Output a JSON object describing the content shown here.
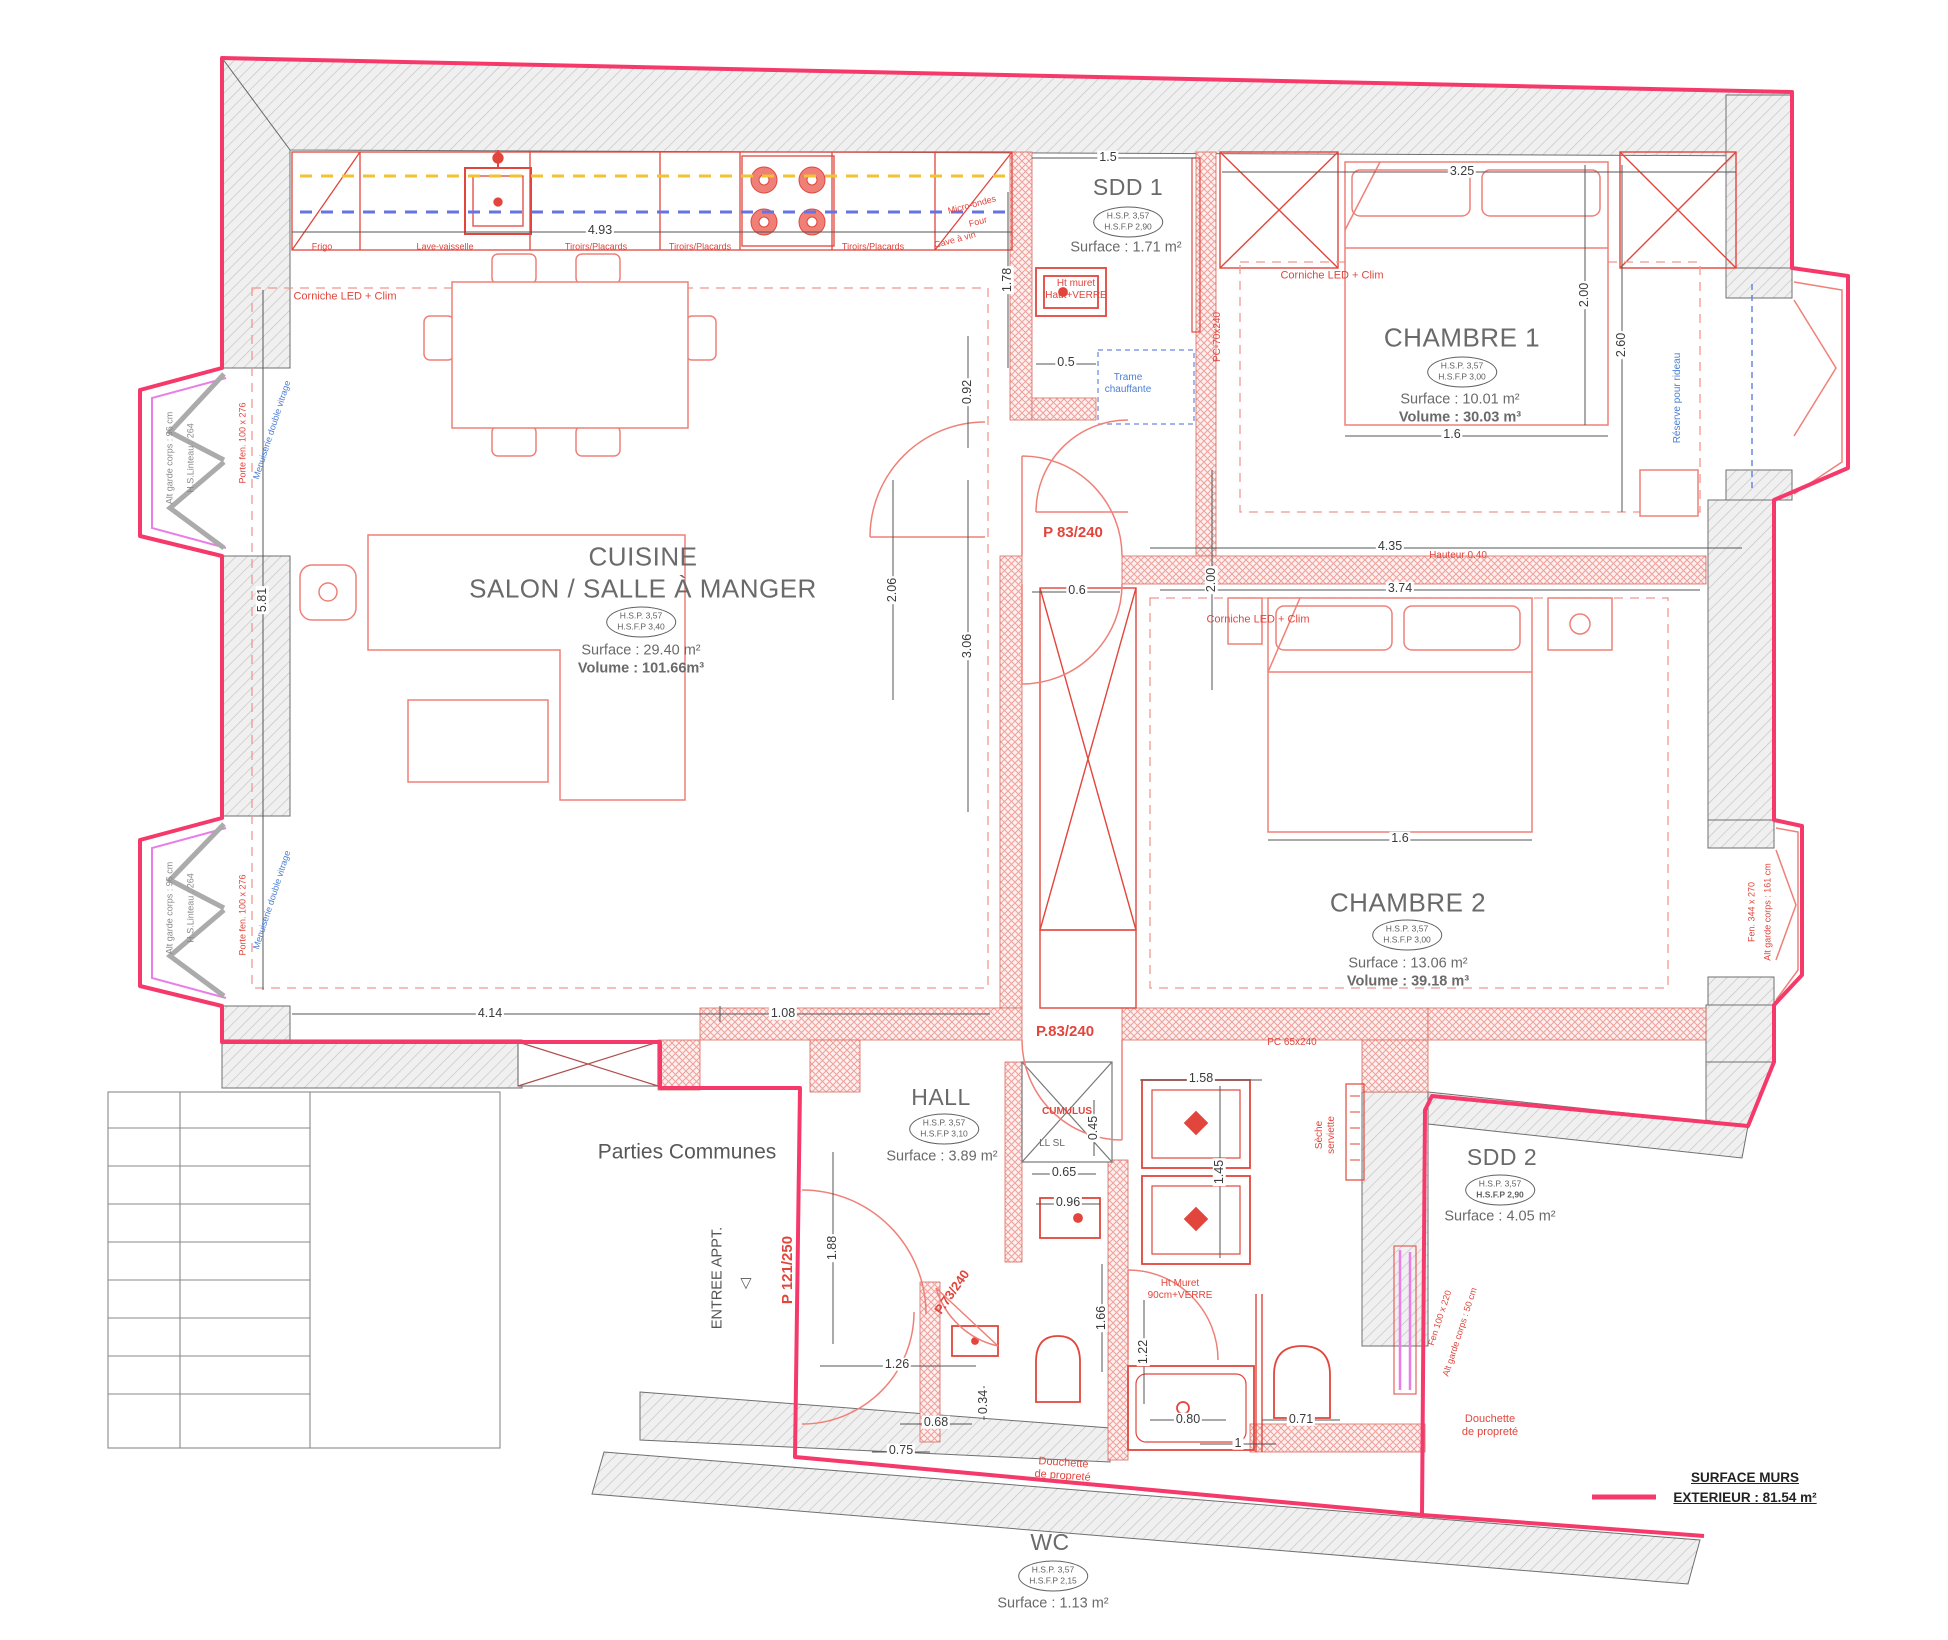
{
  "plan": {
    "rooms": {
      "cuisine": {
        "title": "CUISINE",
        "subtitle": "SALON / SALLE À MANGER",
        "hsp": "H.S.P. 3,57",
        "hsfp": "H.S.F.P 3,40",
        "surface": "Surface : 29.40 m²",
        "volume": "Volume : 101.66m³"
      },
      "sdd1": {
        "title": "SDD 1",
        "hsp": "H.S.P. 3,57",
        "hsfp": "H.S.F.P 2,90",
        "surface": "Surface : 1.71 m²"
      },
      "chambre1": {
        "title": "CHAMBRE 1",
        "hsp": "H.S.P. 3,57",
        "hsfp": "H.S.F.P 3,00",
        "surface": "Surface : 10.01 m²",
        "volume": "Volume : 30.03 m³"
      },
      "chambre2": {
        "title": "CHAMBRE 2",
        "hsp": "H.S.P. 3,57",
        "hsfp": "H.S.F.P 3,00",
        "surface": "Surface : 13.06 m²",
        "volume": "Volume : 39.18 m³"
      },
      "hall": {
        "title": "HALL",
        "hsp": "H.S.P. 3,57",
        "hsfp": "H.S.F.P 3,10",
        "surface": "Surface : 3.89 m²"
      },
      "sdd2": {
        "title": "SDD 2",
        "hsp": "H.S.P. 3,57",
        "hsfp": "H.S.F.P 2,90",
        "surface": "Surface : 4.05 m²"
      },
      "wc": {
        "title": "WC",
        "hsp": "H.S.P. 3,57",
        "hsfp": "H.S.F.P 2,15",
        "surface": "Surface : 1.13 m²"
      },
      "communs": {
        "title": "Parties Communes"
      }
    },
    "kitchen": {
      "frigo": "Frigo",
      "lave_vaisselle": "Lave-vaisselle",
      "tiroirs": "Tiroirs/Placards",
      "micro_ondes": "Micro-ondes",
      "four": "Four",
      "cave_a_vin": "Cave à vin"
    },
    "annotations": {
      "corniche": "Corniche LED + Clim",
      "trame1": "Trame",
      "trame2": "chauffante",
      "pc70": "PC-70x240",
      "pc65": "PC 65x240",
      "p83_1": "P 83/240",
      "p83_2": "P.83/240",
      "p73": "P.73/240",
      "p121": "P 121/250",
      "entree": "ENTREE APPT.",
      "entree_mark": "▽",
      "cumulus": "CUMULUS",
      "ll_sl": "LL   SL",
      "muret1a": "Ht muret",
      "muret1b": "Haut+VERRE",
      "muret2a": "Ht Muret",
      "muret2b": "90cm+VERRE",
      "seche1": "Sèche",
      "seche2": "serviette",
      "douchette1": "Douchette",
      "douchette2": "de propreté",
      "hauteur": "Hauteur 0.40",
      "reserve_rideau": "Réserve pour rideau",
      "menuiserie": "Menuiserie double vitrage",
      "garde96": "Alt garde corps : 96 cm",
      "linteau": "H.S.Linteau : 264",
      "porte_fen": "Porte fen. 100 x 276",
      "fen344": "Fen. 344 x 270",
      "garde161": "Alt garde corps : 161 cm",
      "fen100": "Fen 100 x 220",
      "garde50": "Alt garde corps : 50 cm"
    },
    "dims": {
      "kitchen_width": "4.93",
      "salon_height": "5.81",
      "salon_width": "4.14",
      "hall_top": "1.08",
      "sdd1_width": "1.5",
      "sdd1_depth": "1.78",
      "sdd1_gap": "0.5",
      "chambre1_width": "3.25",
      "chambre1_bed_len": "2.00",
      "chambre1_height": "2.60",
      "chambre1_bed_w": "1.6",
      "wall_top": "4.35",
      "wall_bottom": "3.74",
      "door_offset": "0.6",
      "corridor": "0.92",
      "dressing_h": "2.06",
      "salon_right": "3.06",
      "chambre2_bed_len": "2.00",
      "chambre2_bed_w": "1.6",
      "entry": "1.88",
      "hall_door": "1.26",
      "wc_w": "0.68",
      "wc_d": "0.34",
      "wc_front": "0.75",
      "cumulus_w": "0.65",
      "lavabo_w": "0.96",
      "cumulus_d": "0.45",
      "sdd2_top": "1.58",
      "sdd2_left": "1.45",
      "muret_h": "1.66",
      "muret_h2": "1.22",
      "shower_w": "0.80",
      "wc2_w": "0.71",
      "sdd2_one": "1"
    },
    "legend": {
      "line1": "SURFACE MURS",
      "line2": "EXTERIEUR : 81.54 m²"
    }
  }
}
